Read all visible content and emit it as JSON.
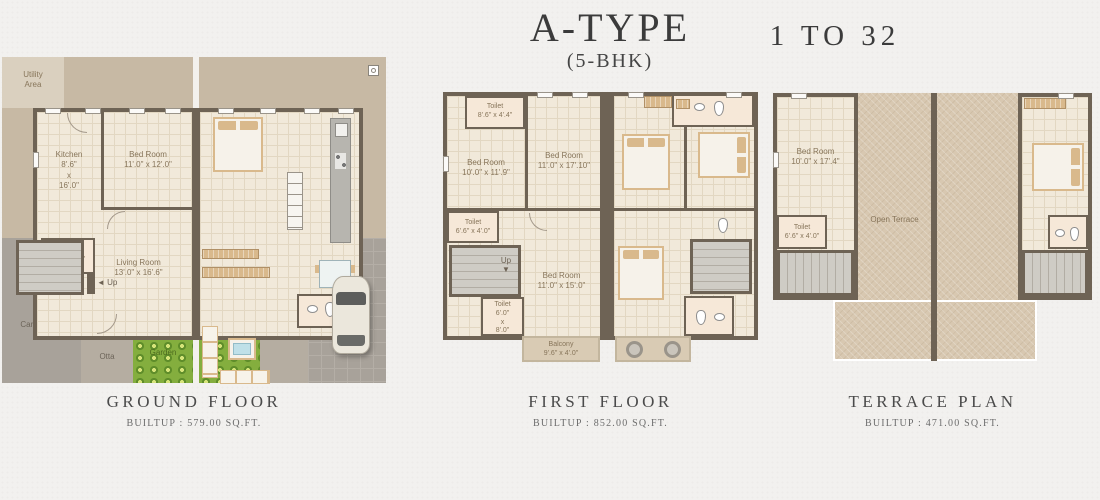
{
  "header": {
    "title": "A-TYPE",
    "subtitle": "(5-BHK)",
    "range": "1 TO 32"
  },
  "ground": {
    "caption": "GROUND FLOOR",
    "builtup": "BUILTUP : 579.00 SQ.FT.",
    "utility_l1": "Utility",
    "utility_l2": "Area",
    "kitchen_nm": "Kitchen",
    "kitchen_d1": "8'.6\"",
    "kitchen_x": "x",
    "kitchen_d2": "16'.0\"",
    "bed_nm": "Bed Room",
    "bed_dim": "11'.0\" x 12'.0\"",
    "toilet_nm": "Toilet",
    "toilet_dim": "6'.6\" x 4'.0\"",
    "living_nm": "Living Room",
    "living_dim": "13'.0\" x 16'.6\"",
    "up_arrow": "◄",
    "up": "Up",
    "car_parking": "Car Parking",
    "otta": "Otta",
    "garden": "Garden"
  },
  "first": {
    "caption": "FIRST FLOOR",
    "builtup": "BUILTUP : 852.00 SQ.FT.",
    "toilet_top_nm": "Toilet",
    "toilet_top_dim": "8'.6\" x 4'.4\"",
    "bed1_nm": "Bed Room",
    "bed1_dim": "10'.0\" x 11'.9\"",
    "bed2_nm": "Bed Room",
    "bed2_dim": "11'.0\" x 17'.10\"",
    "toilet_mid_nm": "Toilet",
    "toilet_mid_dim": "6'.6\" x 4'.0\"",
    "up": "Up",
    "down_arrow": "▼",
    "bed3_nm": "Bed Room",
    "bed3_dim": "11'.0\" x 15'.0\"",
    "toilet_bot_nm": "Toilet",
    "toilet_bot_d1": "6'.0\"",
    "toilet_bot_x": "x",
    "toilet_bot_d2": "8'.0\"",
    "balcony_nm": "Balcony",
    "balcony_dim": "9'.6\" x 4'.0\""
  },
  "terrace": {
    "caption": "TERRACE PLAN",
    "builtup": "BUILTUP : 471.00 SQ.FT.",
    "bed_nm": "Bed Room",
    "bed_dim": "10'.0\" x 17'.4\"",
    "toilet_nm": "Toilet",
    "toilet_dim": "6'.6\" x 4'.0\"",
    "open_terrace": "Open Terrace"
  },
  "colors": {
    "wall": "#6e6355",
    "floor": "#f1e9da",
    "floorline": "#e2d7c2",
    "surround": "#c7b9a4",
    "utility": "#dad0bf",
    "parking": "#a8a29a",
    "otta": "#b5ada1",
    "garden": "#84ae3e",
    "terrace": "#d8c8b1",
    "balcony": "#d9cbb4",
    "toiletfloor": "#f6e8d8",
    "furn": "#d9b98c",
    "paper": "#f2f1ef",
    "ink": "#3b3b3b",
    "label": "#87755a"
  }
}
